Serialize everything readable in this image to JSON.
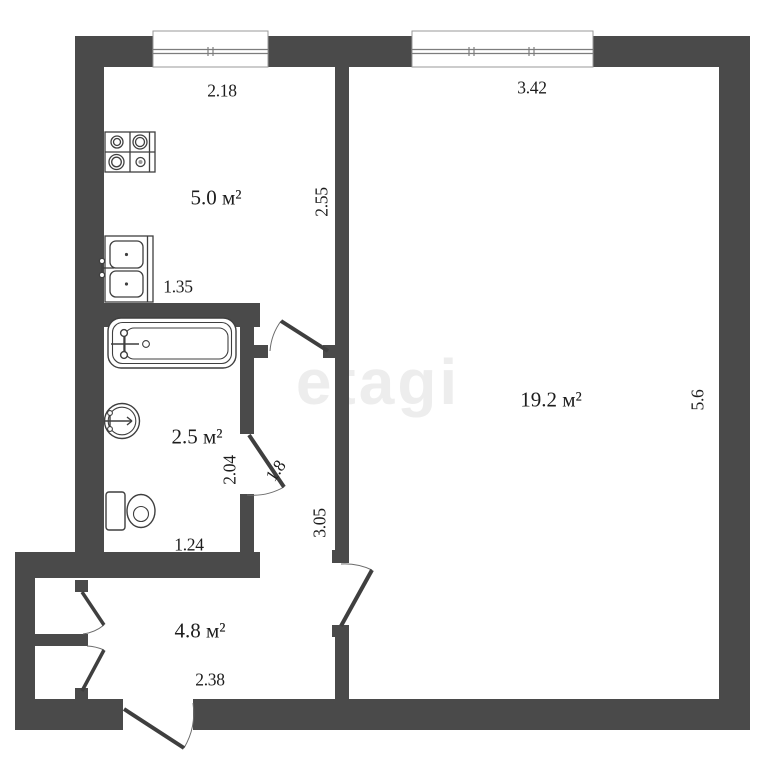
{
  "plan": {
    "watermark": "etagi",
    "colors": {
      "wall": "#4a4a4a",
      "fixture_stroke": "#3f3f3f",
      "label_text": "#1d1d1d",
      "watermark_gray": "#ededed",
      "background": "#ffffff"
    },
    "rooms": {
      "kitchen": {
        "area_label": "5.0 м²",
        "dim_top": "2.18",
        "dim_right": "2.55",
        "dim_bottom": "1.35"
      },
      "bathroom": {
        "area_label": "2.5 м²",
        "dim_right": "2.04",
        "dim_bottom": "1.24",
        "door_width": "1.8"
      },
      "living_room": {
        "area_label": "19.2 м²",
        "dim_top": "3.42",
        "dim_right": "5.6"
      },
      "hallway": {
        "area_label": "4.8 м²",
        "dim_bottom": "2.38",
        "dim_corridor": "3.05"
      }
    }
  }
}
